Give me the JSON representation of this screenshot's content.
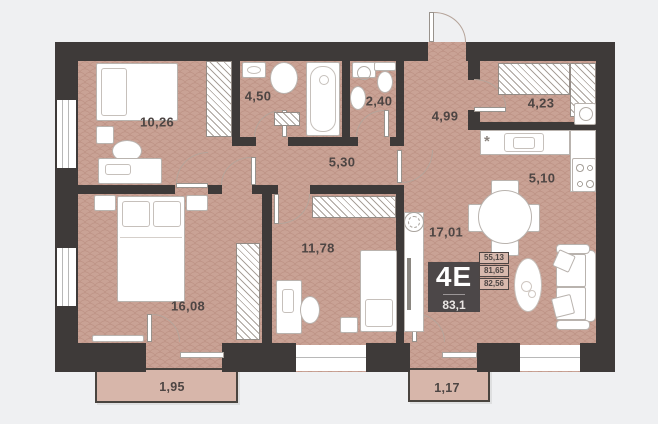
{
  "plan": {
    "title": "apartment-floor-plan",
    "rooms": [
      {
        "name": "bedroom-1",
        "area": "10,26"
      },
      {
        "name": "bathroom",
        "area": "4,50"
      },
      {
        "name": "wc",
        "area": "2,40"
      },
      {
        "name": "hallway",
        "area": "4,99"
      },
      {
        "name": "storage",
        "area": "4,23"
      },
      {
        "name": "corridor",
        "area": "5,30"
      },
      {
        "name": "kitchen",
        "area": "5,10"
      },
      {
        "name": "bedroom-2",
        "area": "16,08"
      },
      {
        "name": "bedroom-3",
        "area": "11,78"
      },
      {
        "name": "living-room",
        "area": "17,01"
      },
      {
        "name": "balcony-1",
        "area": "1,95"
      },
      {
        "name": "balcony-2",
        "area": "1,17"
      }
    ],
    "badge": {
      "unit_type": "4E",
      "total_area": "83,1"
    },
    "metrics": [
      "55,13",
      "81,65",
      "82,56"
    ],
    "icons": {
      "fridge_symbol": "*"
    },
    "colors": {
      "wall": "#3e3a39",
      "floor": "#c9a295",
      "balcony_floor": "#d7b6aa",
      "background": "#eff0f2",
      "badge_bg": "#4c4748",
      "label_text": "#4d4543"
    }
  }
}
